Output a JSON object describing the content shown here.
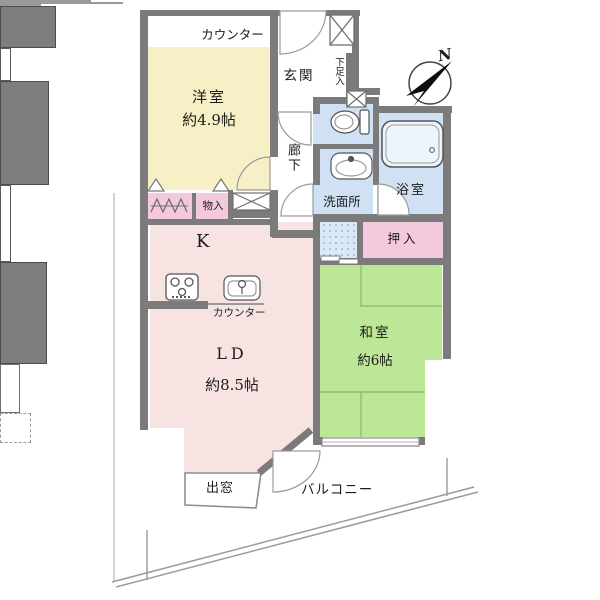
{
  "plan": {
    "compass": {
      "north_label": "N"
    },
    "labels": {
      "counter_top": "カウンター",
      "western_room_name": "洋室",
      "western_room_size": "約4.9帖",
      "entrance": "玄関",
      "shoe_box": "下足入",
      "hallway": "廊下",
      "washroom": "洗面所",
      "bathroom": "浴室",
      "oshiire_closet": "押入",
      "storage": "物入",
      "kitchen": "K",
      "kitchen_counter": "カウンター",
      "living_dining_name": "LD",
      "living_dining_size": "約8.5帖",
      "japanese_room_name": "和室",
      "japanese_room_size": "約6帖",
      "bay_window": "出窓",
      "balcony": "バルコニー"
    },
    "colors": {
      "wall": "#7b7b7b",
      "western_room": "#f7efc5",
      "living_kitchen": "#f8e3e3",
      "closet_pink": "#f4c9dd",
      "wet_area_blue": "#cfe1f3",
      "japanese_room_green": "#bbe797"
    }
  }
}
